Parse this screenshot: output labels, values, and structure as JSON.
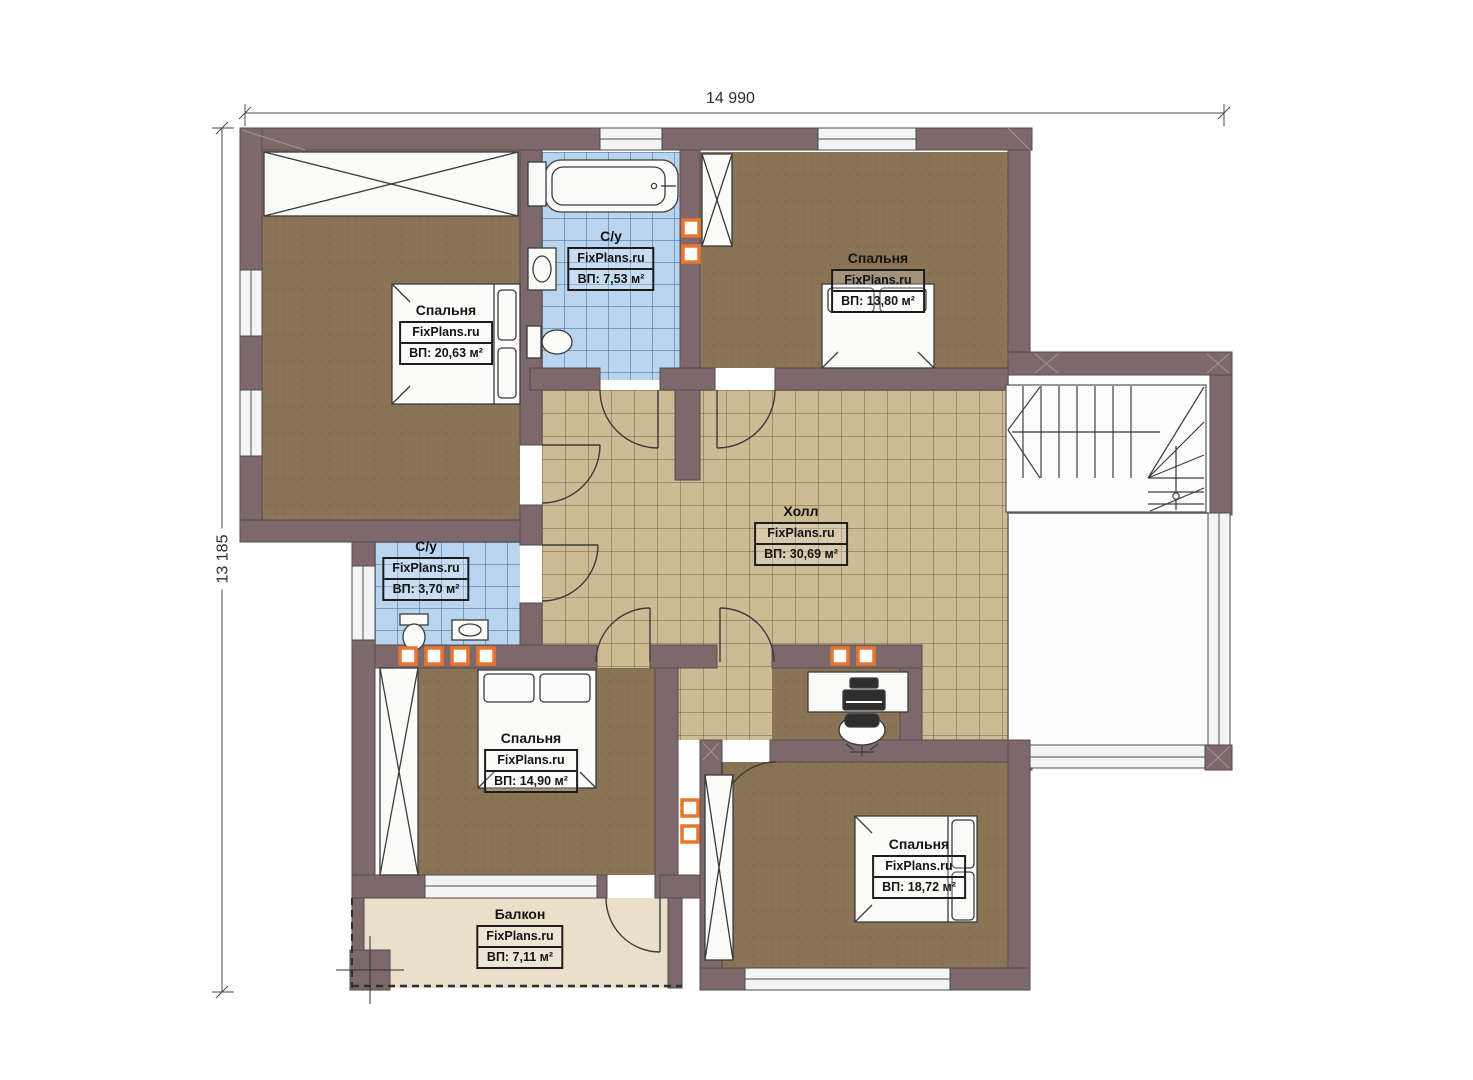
{
  "plan": {
    "brand_watermark": "FixPlans.ru",
    "dimensions": {
      "width_label": "14 990",
      "height_label": "13 185"
    },
    "rooms": [
      {
        "id": "bedroom-master",
        "name": "Спальня",
        "brand": "FixPlans.ru",
        "area": "ВП: 20,63 м²"
      },
      {
        "id": "bathroom-top",
        "name": "С/у",
        "brand": "FixPlans.ru",
        "area": "ВП: 7,53 м²"
      },
      {
        "id": "bedroom-top-right",
        "name": "Спальня",
        "brand": "FixPlans.ru",
        "area": "ВП: 13,80 м²"
      },
      {
        "id": "hall",
        "name": "Холл",
        "brand": "FixPlans.ru",
        "area": "ВП: 30,69 м²"
      },
      {
        "id": "bathroom-small",
        "name": "С/у",
        "brand": "FixPlans.ru",
        "area": "ВП: 3,70 м²"
      },
      {
        "id": "bedroom-bottom-mid",
        "name": "Спальня",
        "brand": "FixPlans.ru",
        "area": "ВП: 14,90 м²"
      },
      {
        "id": "bedroom-bottom-right",
        "name": "Спальня",
        "brand": "FixPlans.ru",
        "area": "ВП: 18,72 м²"
      },
      {
        "id": "balcony",
        "name": "Балкон",
        "brand": "FixPlans.ru",
        "area": "ВП: 7,11 м²"
      }
    ],
    "colors": {
      "wall": "#7d696c",
      "bedroom_floor": "#8b7456",
      "hall_tile": "#cdbb96",
      "bath_tile": "#b9d4ef",
      "balcony_floor": "#e9dfca",
      "vent_accent": "#e8762f"
    }
  }
}
